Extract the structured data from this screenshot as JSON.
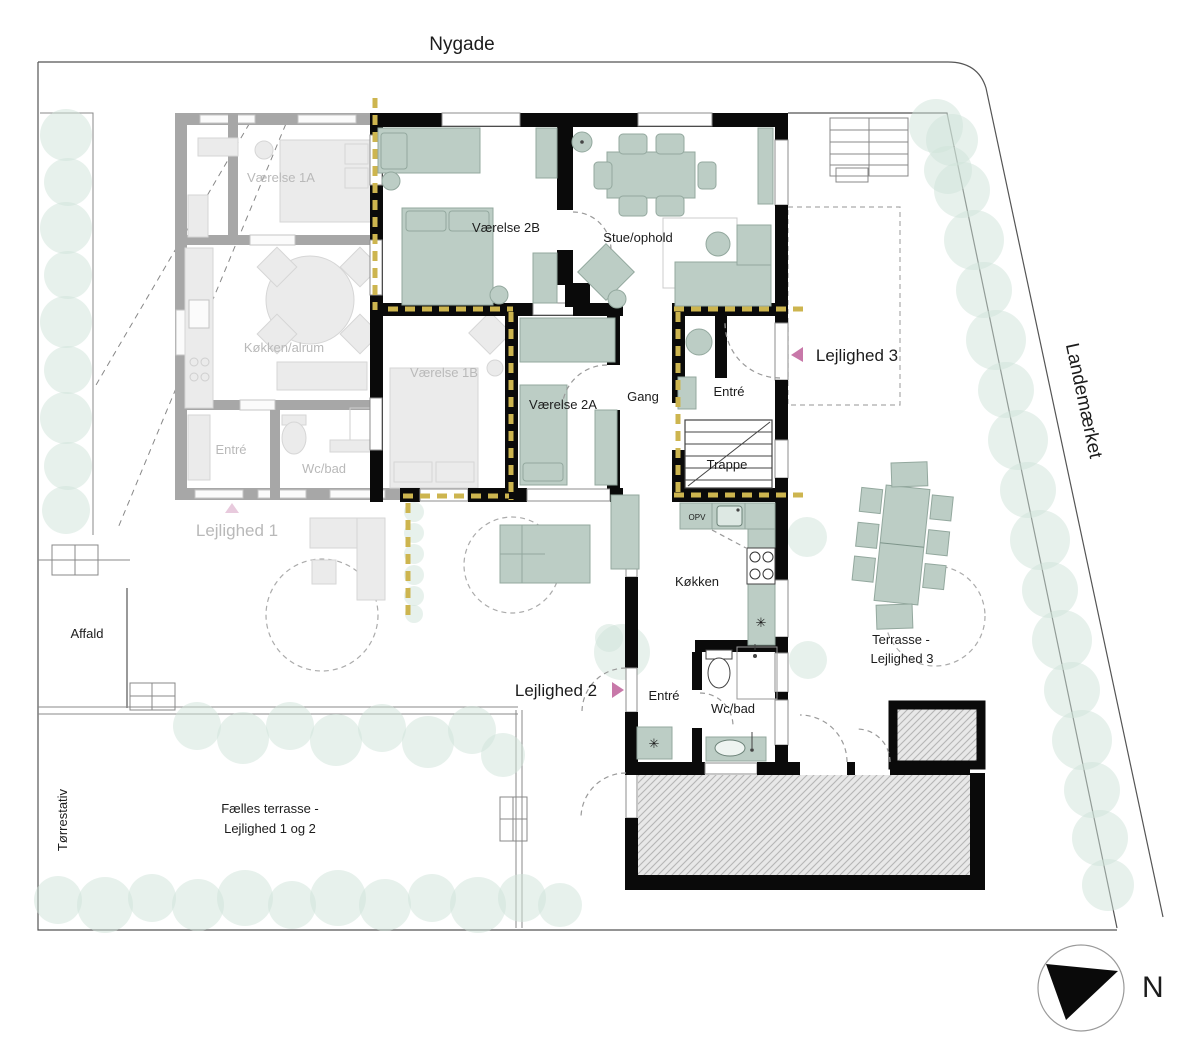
{
  "plan": {
    "streets": {
      "top": "Nygade",
      "right": "Landemærket"
    },
    "north_label": "N",
    "apartment1": {
      "name": "Lejlighed 1",
      "rooms": {
        "vaerelse_1a": "Værelse 1A",
        "koekken_alrum": "Køkken/alrum",
        "entre": "Entré",
        "wc_bad": "Wc/bad",
        "vaerelse_1b": "Værelse 1B"
      }
    },
    "apartment2": {
      "name": "Lejlighed 2",
      "rooms": {
        "vaerelse_2b": "Værelse 2B",
        "stue_ophold": "Stue/ophold",
        "vaerelse_2a": "Værelse 2A",
        "gang": "Gang",
        "koekken": "Køkken",
        "entre": "Entré",
        "wc_bad": "Wc/bad"
      }
    },
    "apartment3": {
      "name": "Lejlighed 3",
      "rooms": {
        "entre": "Entré",
        "trappe": "Trappe"
      }
    },
    "appliances": {
      "dishwasher": "OPV"
    },
    "outdoor": {
      "affald": "Affald",
      "toerrestativ": "Tørrestativ",
      "faelles_terrasse_line1": "Fælles terrasse -",
      "faelles_terrasse_line2": "Lejlighed 1 og 2",
      "terrasse3_line1": "Terrasse -",
      "terrasse3_line2": "Lejlighed 3"
    },
    "colors": {
      "wall": "#0a0a0a",
      "faded_wall": "#a7a7a7",
      "furniture_green": "#bccdc5",
      "tree_green": "#cfe3da",
      "fire_line_yellow": "#cdb54f",
      "entrance_arrow_pink": "#c878a9",
      "hatch_gray": "#b5b5b5"
    }
  }
}
